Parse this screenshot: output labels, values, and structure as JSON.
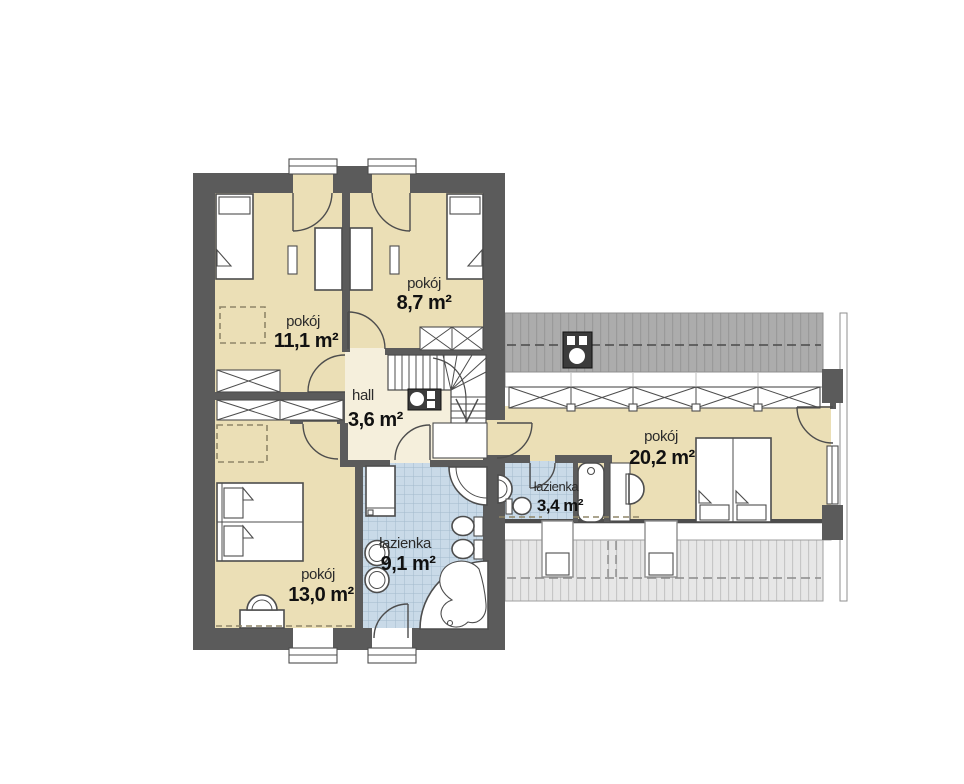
{
  "rooms": [
    {
      "name": "pokój",
      "area": "11,1 m²"
    },
    {
      "name": "pokój",
      "area": "8,7 m²"
    },
    {
      "name": "hall",
      "area": "3,6 m²"
    },
    {
      "name": "pokój",
      "area": "13,0 m²"
    },
    {
      "name": "łazienka",
      "area": "9,1 m²"
    },
    {
      "name": "łazienka",
      "area": "3,4 m²"
    },
    {
      "name": "pokój",
      "area": "20,2 m²"
    }
  ],
  "colors": {
    "wall": "#5B5B5B",
    "room_fill": "#EBDFB6",
    "hall_fill": "#F5EFDC",
    "bathroom_tile": "#C9DAE8",
    "bathroom_tile_grid": "#A3BACD",
    "roof_dark": "#ACACAC",
    "roof_light": "#E7E7E7",
    "furniture_outline": "#4D4D4D",
    "dashed_guide": "#8F8668",
    "label_text": "#111111"
  }
}
